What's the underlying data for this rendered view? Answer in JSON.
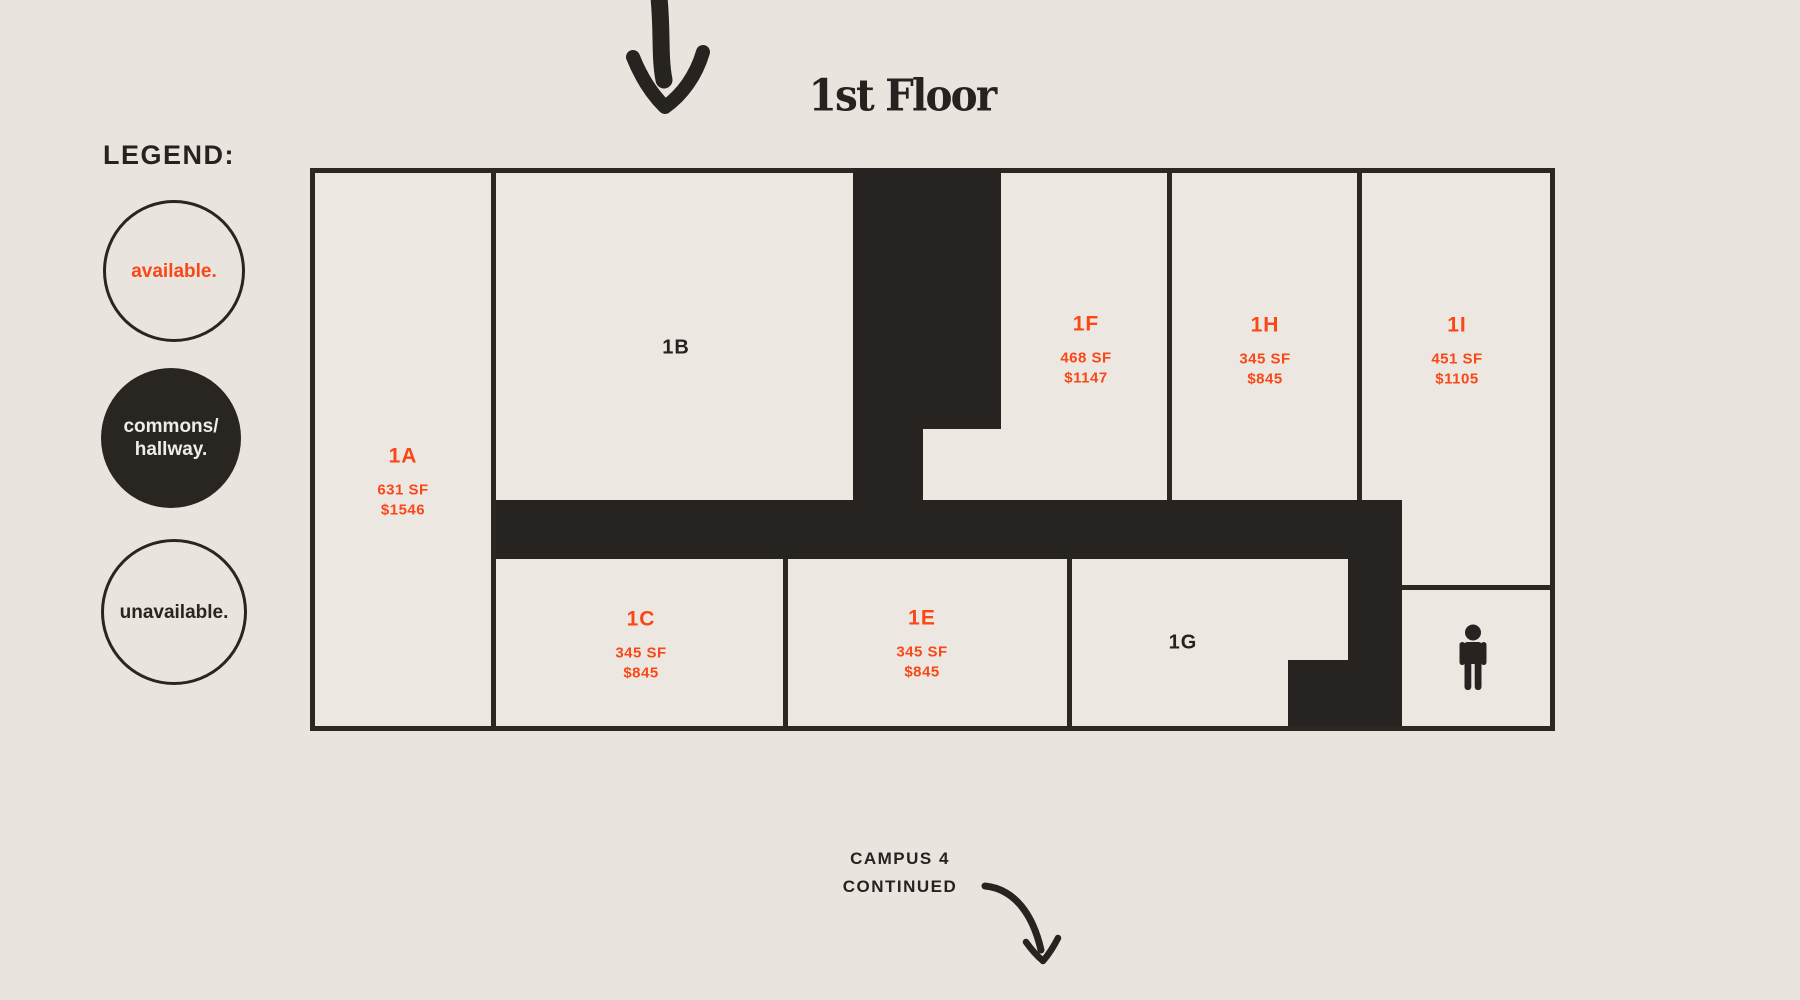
{
  "title": "1st Floor",
  "legend": {
    "heading": "LEGEND:",
    "available_label": "available.",
    "commons_line1": "commons/",
    "commons_line2": "hallway.",
    "unavailable_label": "unavailable."
  },
  "rooms": [
    {
      "id": "1A",
      "sf": "631 SF",
      "price": "$1546",
      "status": "available"
    },
    {
      "id": "1B",
      "status": "unavailable"
    },
    {
      "id": "1C",
      "sf": "345 SF",
      "price": "$845",
      "status": "available"
    },
    {
      "id": "1E",
      "sf": "345 SF",
      "price": "$845",
      "status": "available"
    },
    {
      "id": "1F",
      "sf": "468 SF",
      "price": "$1147",
      "status": "available"
    },
    {
      "id": "1G",
      "status": "unavailable"
    },
    {
      "id": "1H",
      "sf": "345 SF",
      "price": "$845",
      "status": "available"
    },
    {
      "id": "1I",
      "sf": "451 SF",
      "price": "$1105",
      "status": "available"
    }
  ],
  "footer": {
    "line1": "CAMPUS 4",
    "line2": "CONTINUED"
  },
  "icons": {
    "top_arrow": "curved-arrow-down-icon",
    "footer_arrow": "curved-arrow-down-right-icon",
    "restroom": "male-restroom-icon"
  },
  "colors": {
    "background": "#E9E5DE",
    "plan_fill": "#ECE8E1",
    "wall_dark": "#292520",
    "accent_orange": "#FA4717"
  }
}
